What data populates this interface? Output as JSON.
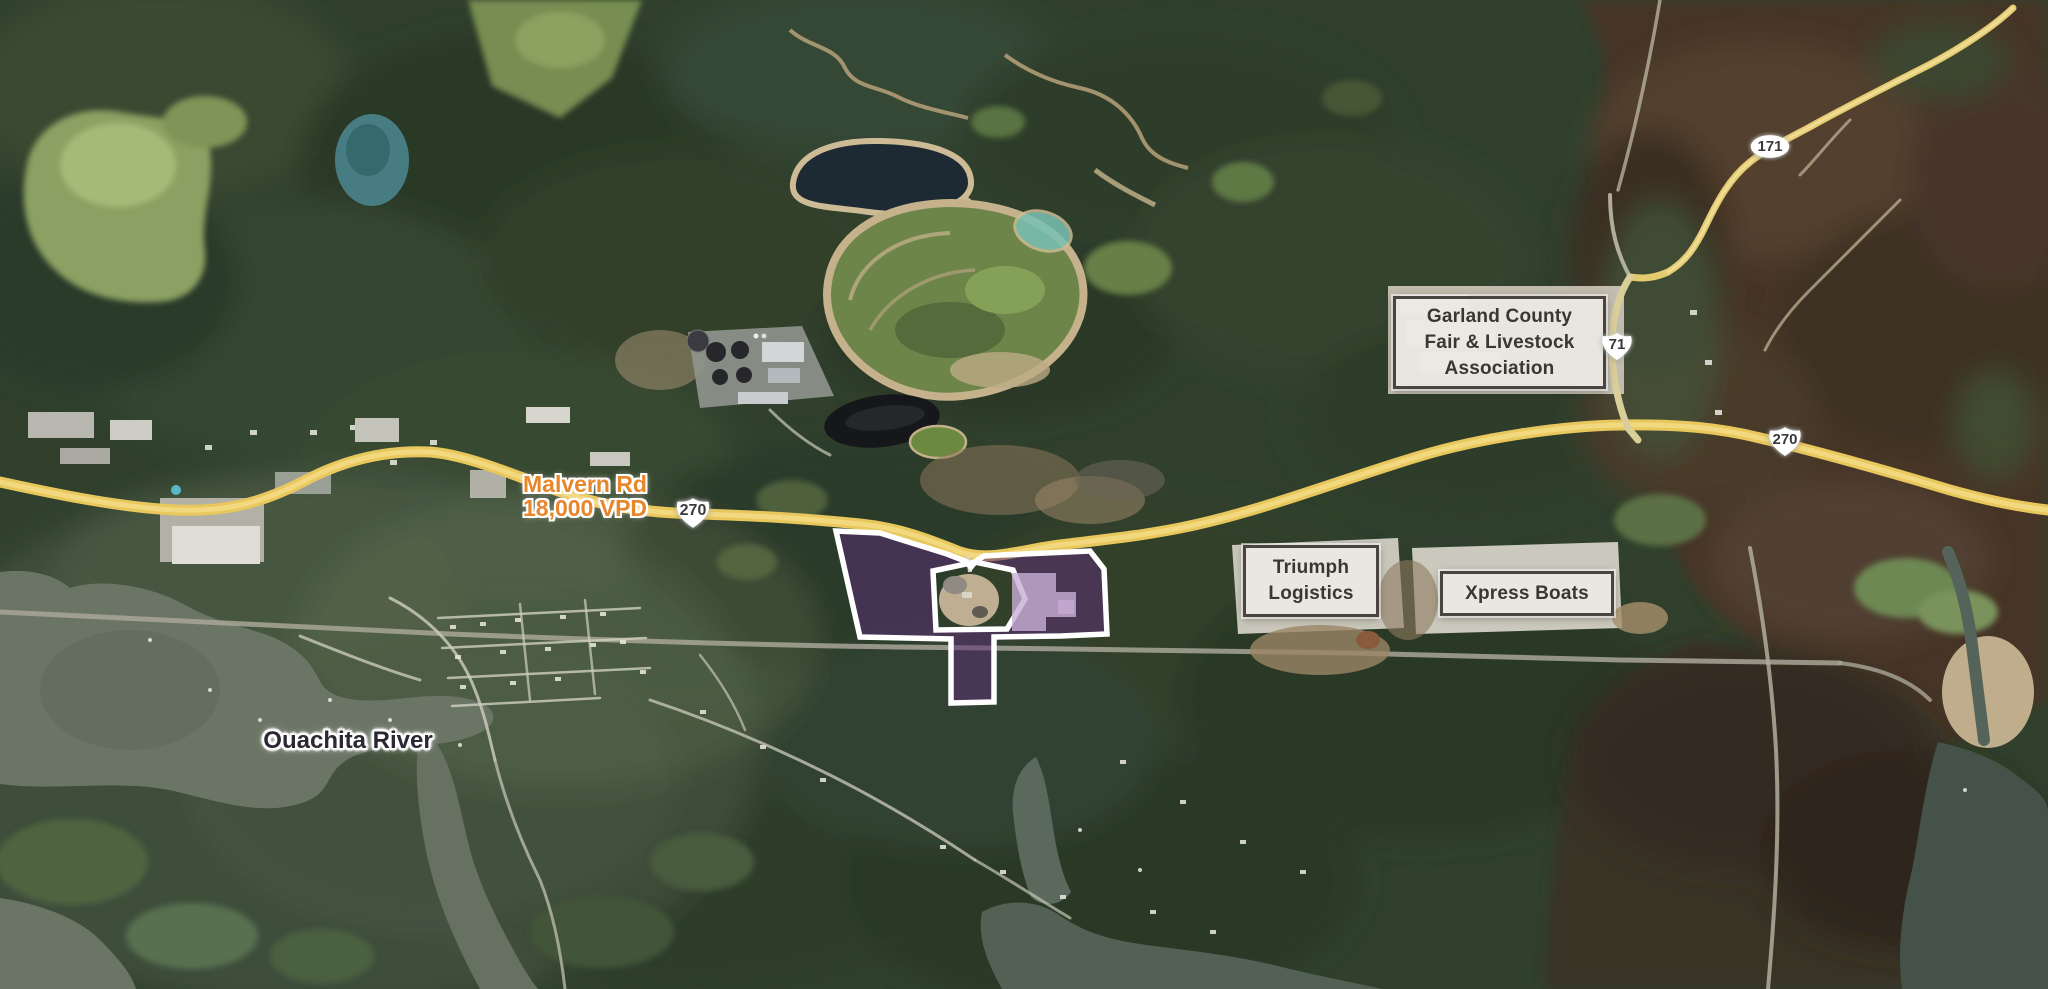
{
  "poi_labels": {
    "garland": {
      "line1": "Garland County",
      "line2": "Fair & Livestock",
      "line3": "Association"
    },
    "triumph": {
      "line1": "Triumph",
      "line2": "Logistics"
    },
    "xpress": {
      "line1": "Xpress Boats"
    }
  },
  "road_labels": {
    "malvern": {
      "name": "Malvern Rd",
      "traffic": "18,000 VPD"
    }
  },
  "water_labels": {
    "river": "Ouachita River"
  },
  "route_shields": {
    "hwy171": "171",
    "hwy71": "71",
    "us270_west": "270",
    "us270_east": "270"
  },
  "parcel": {
    "fill_color": "#5b2d74",
    "outline_color": "#ffffff"
  },
  "colors": {
    "road_yellow": "#e8c75c",
    "label_orange": "#e8862b",
    "box_background": "#ece9e3",
    "box_border": "#4a4441",
    "box_text": "#3a3733",
    "water_label_text": "#2b2833"
  }
}
